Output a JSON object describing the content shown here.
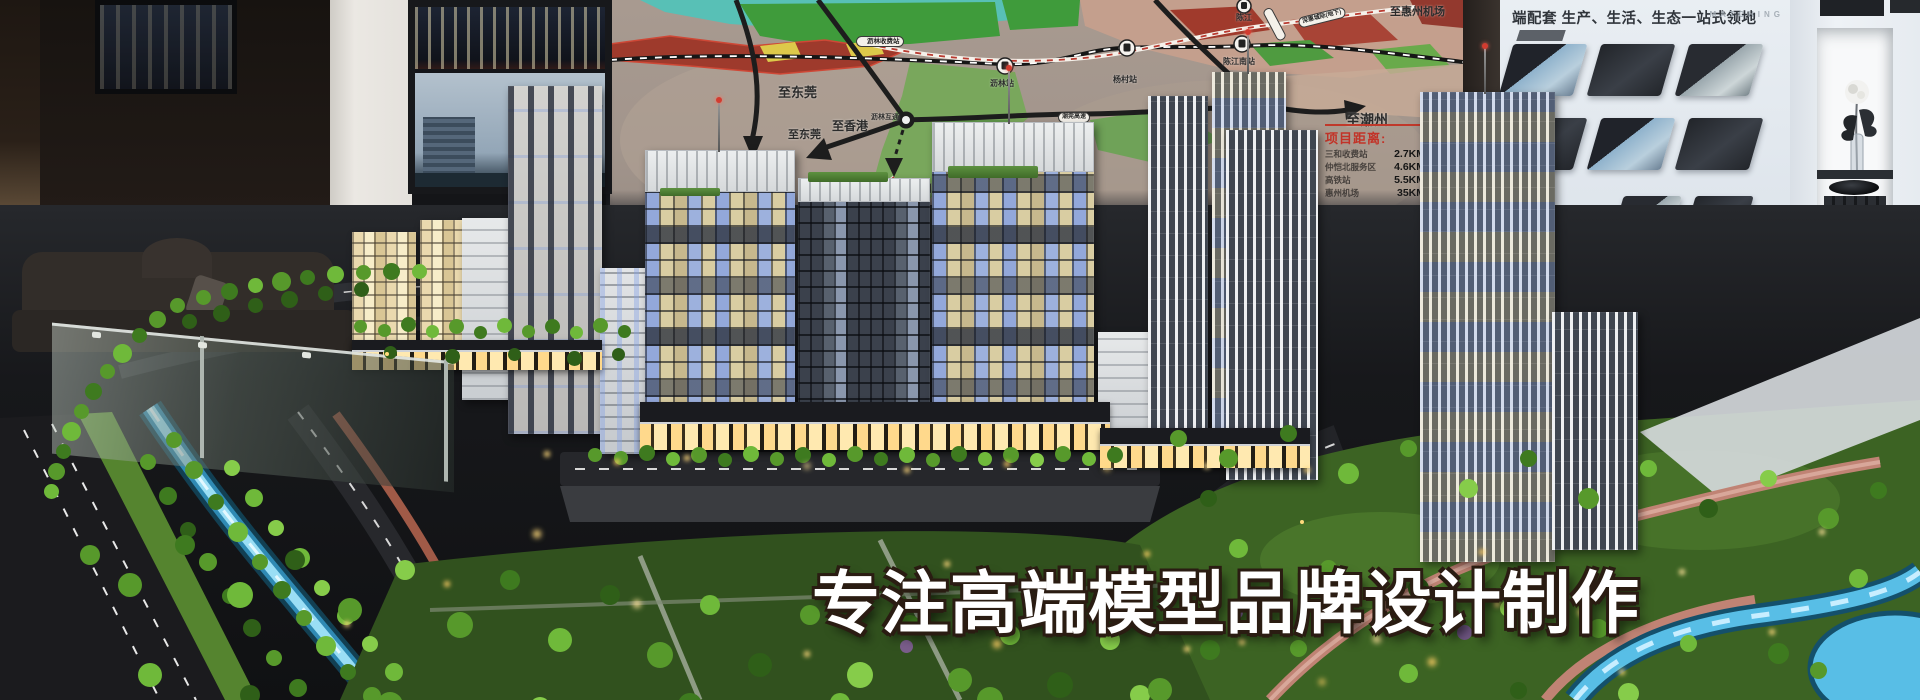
{
  "overlay": {
    "tagline": "专注高端模型品牌设计制作"
  },
  "map": {
    "directions": {
      "dongguan_upper": "至东莞",
      "dongguan_lower": "至东莞",
      "hongkong": "至香港",
      "shenzhen": "至深圳",
      "chaozhou": "至潮州",
      "huizhou_airport": "至惠州机场"
    },
    "stations": {
      "lilin_toll": "沥林收费站",
      "lilin": "沥林站",
      "yangcun": "杨村站",
      "chenjiang": "陈江",
      "chenjiang_south": "陈江南站",
      "zhenlong_interchange": "镇隆互通",
      "lilin_interchange": "沥林互通"
    },
    "roads": {
      "chaowan_expressway": "潮莞高速",
      "intercity_line": "深惠城际(地下)"
    },
    "distance_panel": {
      "title": "项目距离:",
      "rows": [
        {
          "place": "三和收费站",
          "km": "2.7KM"
        },
        {
          "place": "仲恺北服务区",
          "km": "4.6KM"
        },
        {
          "place": "高铁站",
          "km": "5.5KM"
        },
        {
          "place": "惠州机场",
          "km": "35KM"
        }
      ]
    }
  },
  "poster": {
    "tagline": "端配套 生产、生活、生态一站式领地",
    "watermark": "MATCHING"
  },
  "palette": {
    "tagline_fill": "#ffffff",
    "tagline_outline": "#2a1c12",
    "map_accent_red": "#c23328",
    "water": "#58bee6",
    "tree_green": "#57992b",
    "window_warm": "#ffd98c",
    "window_blue": "#93a8da"
  }
}
